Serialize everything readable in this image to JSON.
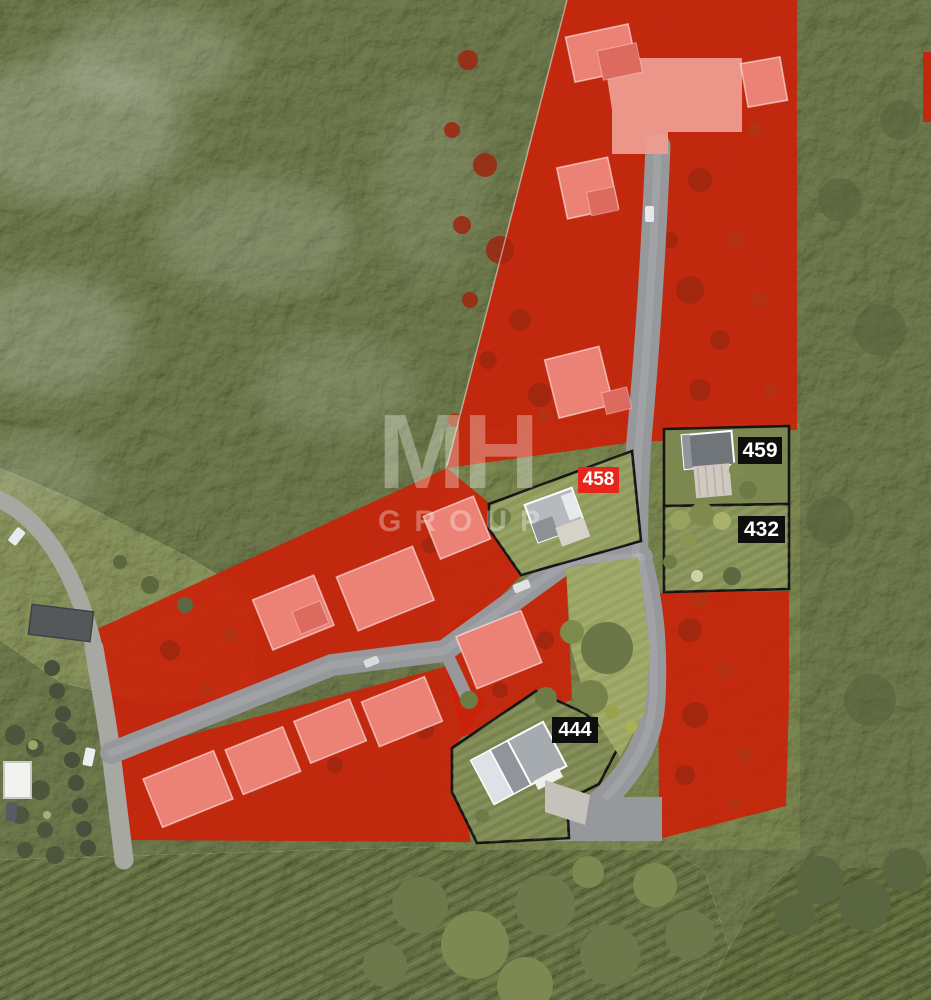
{
  "watermark": {
    "line1": "MH",
    "line2": "GROUP"
  },
  "plots": [
    {
      "id": "458",
      "label": "458",
      "badge_style": "red"
    },
    {
      "id": "459",
      "label": "459",
      "badge_style": "black"
    },
    {
      "id": "432",
      "label": "432",
      "badge_style": "black"
    },
    {
      "id": "444",
      "label": "444",
      "badge_style": "black"
    }
  ],
  "colors": {
    "overlay-red": "#cb2008",
    "badge-red": "#e8251c",
    "badge-black": "#0e0e0e",
    "badge-text": "#ffffff",
    "road-gray": "#96989b",
    "lane-gray": "#a8a8a2",
    "forest-green": "#717d4e",
    "meadow-green": "#8b965e",
    "field-green": "#6d7947",
    "lawn-green": "#97a35e",
    "plot-outline": "#141414",
    "sold-house-pink": "#ec8176",
    "watermark-white": "rgba(255,255,255,0.32)"
  }
}
